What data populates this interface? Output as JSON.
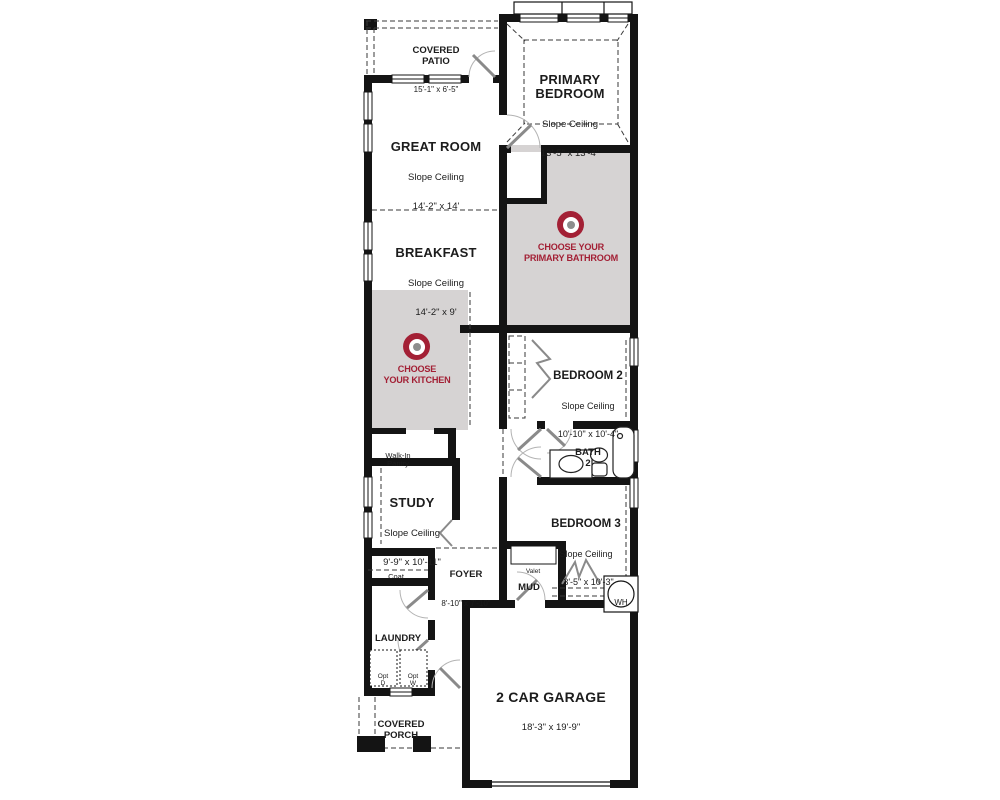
{
  "palette": {
    "wall": "#141414",
    "highlight": "#d6d3d3",
    "accent": "#a32035",
    "text": "#1c1c1c"
  },
  "rooms": {
    "covered_patio": {
      "name": "COVERED\nPATIO",
      "dims": "15'-1\" x 6'-5\""
    },
    "great_room": {
      "name": "GREAT ROOM",
      "ceiling": "Slope Ceiling",
      "dims": "14'-2\" x 14'"
    },
    "primary_bedroom": {
      "name": "PRIMARY\nBEDROOM",
      "ceiling": "Slope Ceiling",
      "dims": "13'-5\" x 13'-4\""
    },
    "breakfast": {
      "name": "BREAKFAST",
      "ceiling": "Slope Ceiling",
      "dims": "14'-2\" x 9'"
    },
    "bedroom_2": {
      "name": "BEDROOM 2",
      "ceiling": "Slope Ceiling",
      "dims": "10'-10\" x 10'-4\""
    },
    "bedroom_3": {
      "name": "BEDROOM 3",
      "ceiling": "Slope Ceiling",
      "dims": "13'-5\" x 10'-3\""
    },
    "bath_2": {
      "name": "BATH\n2"
    },
    "study": {
      "name": "STUDY",
      "ceiling": "Slope Ceiling",
      "dims": "9'-9\" x 10'-11\""
    },
    "walk_in_pantry": {
      "name": "Walk-In\nPantry"
    },
    "coat": {
      "name": "Coat"
    },
    "foyer": {
      "name": "FOYER",
      "dims": "8'-10\" x 7'-10\""
    },
    "valet": {
      "name": "Valet"
    },
    "mud": {
      "name": "MUD"
    },
    "laundry": {
      "name": "LAUNDRY"
    },
    "opt_dryer": {
      "name": "Opt\nD"
    },
    "opt_washer": {
      "name": "Opt\nW"
    },
    "water_heater": {
      "name": "WH"
    },
    "garage": {
      "name": "2 CAR GARAGE",
      "dims": "18'-3\" x 19'-9\""
    },
    "covered_porch": {
      "name": "COVERED\nPORCH"
    }
  },
  "ctas": {
    "kitchen": {
      "label": "CHOOSE\nYOUR KITCHEN",
      "icon": "target-icon"
    },
    "primary_bathroom": {
      "label": "CHOOSE YOUR\nPRIMARY BATHROOM",
      "icon": "target-icon"
    }
  }
}
